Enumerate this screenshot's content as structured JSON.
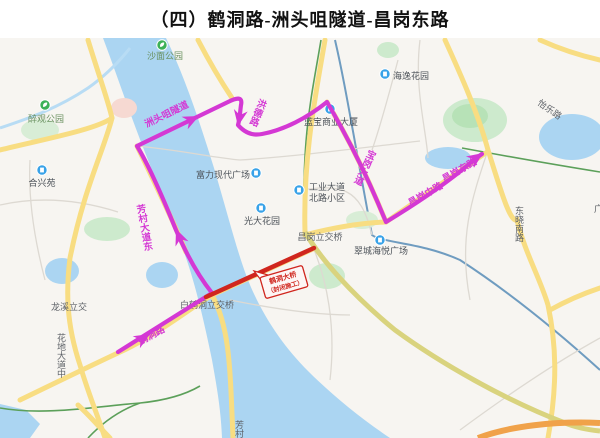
{
  "title": "（四）鹤洞路-洲头咀隧道-昌岗东路",
  "colors": {
    "route": "#d438d4",
    "closure": "#d0261e",
    "water": "#abd5f2",
    "road_major": "#f8dd82",
    "park_fill": "#cdeacd"
  },
  "route": {
    "labels": [
      {
        "text": "鹤洞路"
      },
      {
        "text": "芳村大道东"
      },
      {
        "text": "洲头咀隧道"
      },
      {
        "text": "洪德路"
      },
      {
        "text": "宝岗大道"
      },
      {
        "text": "昌岗中路"
      },
      {
        "text": "昌岗东路"
      }
    ]
  },
  "closure": {
    "line1": "鹤洞大桥",
    "line2": "（封闭施工）"
  },
  "map": {
    "pois": [
      {
        "name": "醉观公园",
        "category": "park"
      },
      {
        "name": "沙面公园",
        "category": "park"
      },
      {
        "name": "合兴苑",
        "category": "residence"
      },
      {
        "name": "海逸花园",
        "category": "residence"
      },
      {
        "name": "富力现代广场",
        "category": "mall"
      },
      {
        "name": "蓝宝商业大厦",
        "category": "office"
      },
      {
        "name": "工业大道",
        "name2": "北路小区",
        "category": "residence"
      },
      {
        "name": "光大花园",
        "category": "residence"
      },
      {
        "name": "翠城海悦广场",
        "category": "mall"
      }
    ],
    "junction_labels": [
      {
        "text": "昌岗立交桥"
      },
      {
        "text": "龙溪立交"
      },
      {
        "text": "白鹤洞立交桥"
      }
    ],
    "road_labels": [
      {
        "text": "花地大道中"
      },
      {
        "text": "东晓南路"
      },
      {
        "text": "芳村"
      },
      {
        "text": "怡乐路"
      },
      {
        "text": "广州"
      }
    ]
  }
}
